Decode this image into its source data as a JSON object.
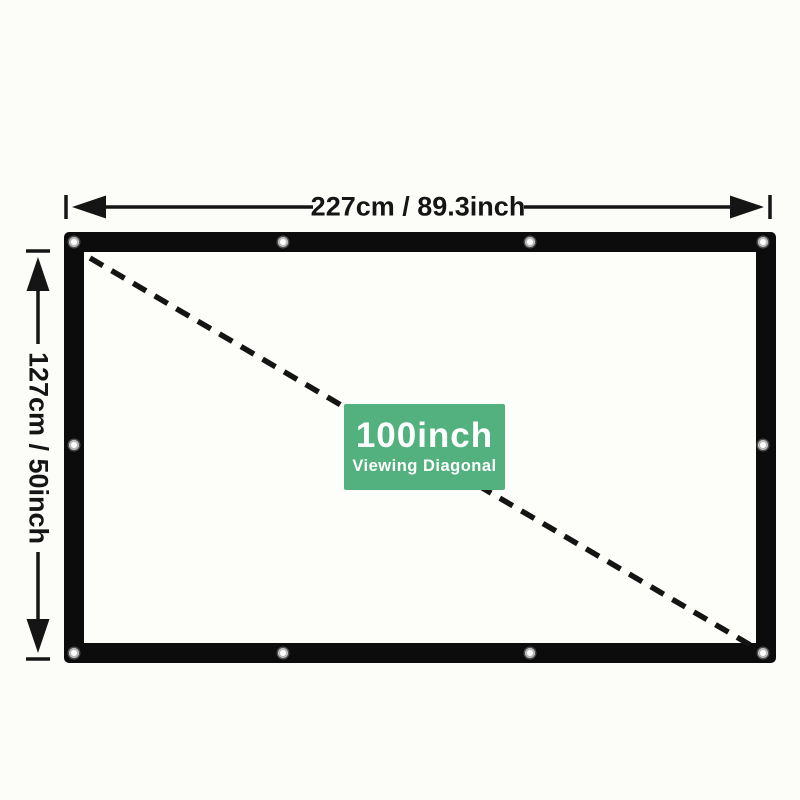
{
  "diagram": {
    "title_hint": "projection screen dimension diagram",
    "width_label": "227cm / 89.3inch",
    "height_label": "127cm / 50inch",
    "badge": {
      "size_label": "100inch",
      "caption": "Viewing Diagonal",
      "background_color": "#52b17f",
      "text_color": "#ffffff"
    },
    "screen": {
      "border_color": "#0c0c0c",
      "surface_color": "#fdfdf9",
      "grommet_count": 10
    },
    "dimension_color": "#151515"
  }
}
